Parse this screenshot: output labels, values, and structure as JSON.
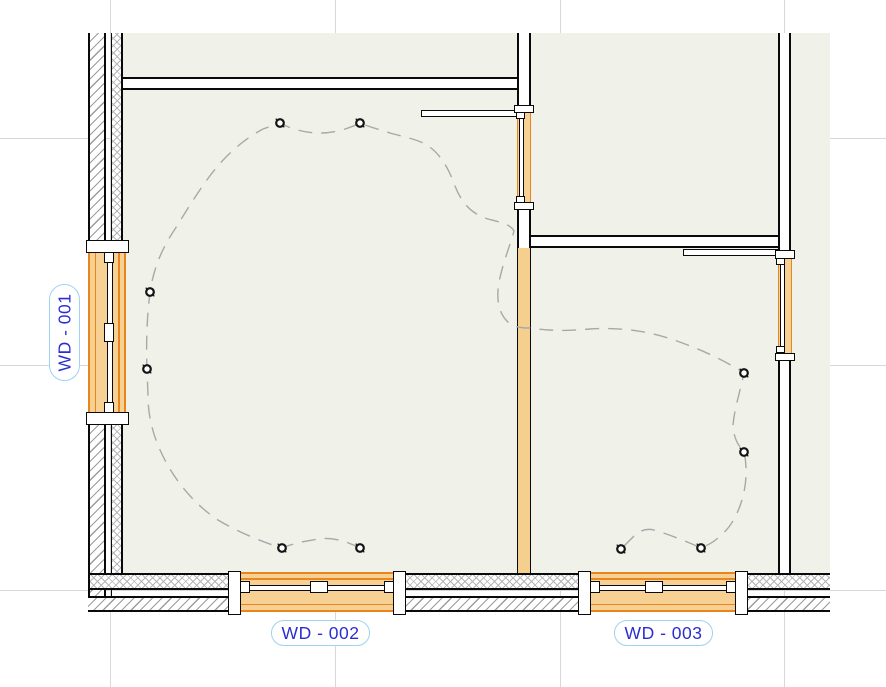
{
  "window_tags": {
    "wd001": {
      "label": "WD - 001"
    },
    "wd002": {
      "label": "WD - 002"
    },
    "wd003": {
      "label": "WD - 003"
    }
  },
  "colors": {
    "interior_fill": "#f0f2e9",
    "wall_line": "#0a0a0a",
    "wall_tan": "#f5cf8e",
    "window_fill": "#f6d193",
    "window_line": "#e8851c",
    "tag_text": "#2a2ed2",
    "tag_outline": "#9fd3f3",
    "grid_line": "#d8d8d8",
    "wiring_dash": "#a8a8a8"
  },
  "fixtures": [
    {
      "x": 280,
      "y": 123
    },
    {
      "x": 360,
      "y": 123
    },
    {
      "x": 150,
      "y": 292
    },
    {
      "x": 147,
      "y": 369
    },
    {
      "x": 282,
      "y": 548
    },
    {
      "x": 360,
      "y": 548
    },
    {
      "x": 744,
      "y": 373
    },
    {
      "x": 744,
      "y": 452
    },
    {
      "x": 701,
      "y": 548
    },
    {
      "x": 621,
      "y": 549
    }
  ]
}
